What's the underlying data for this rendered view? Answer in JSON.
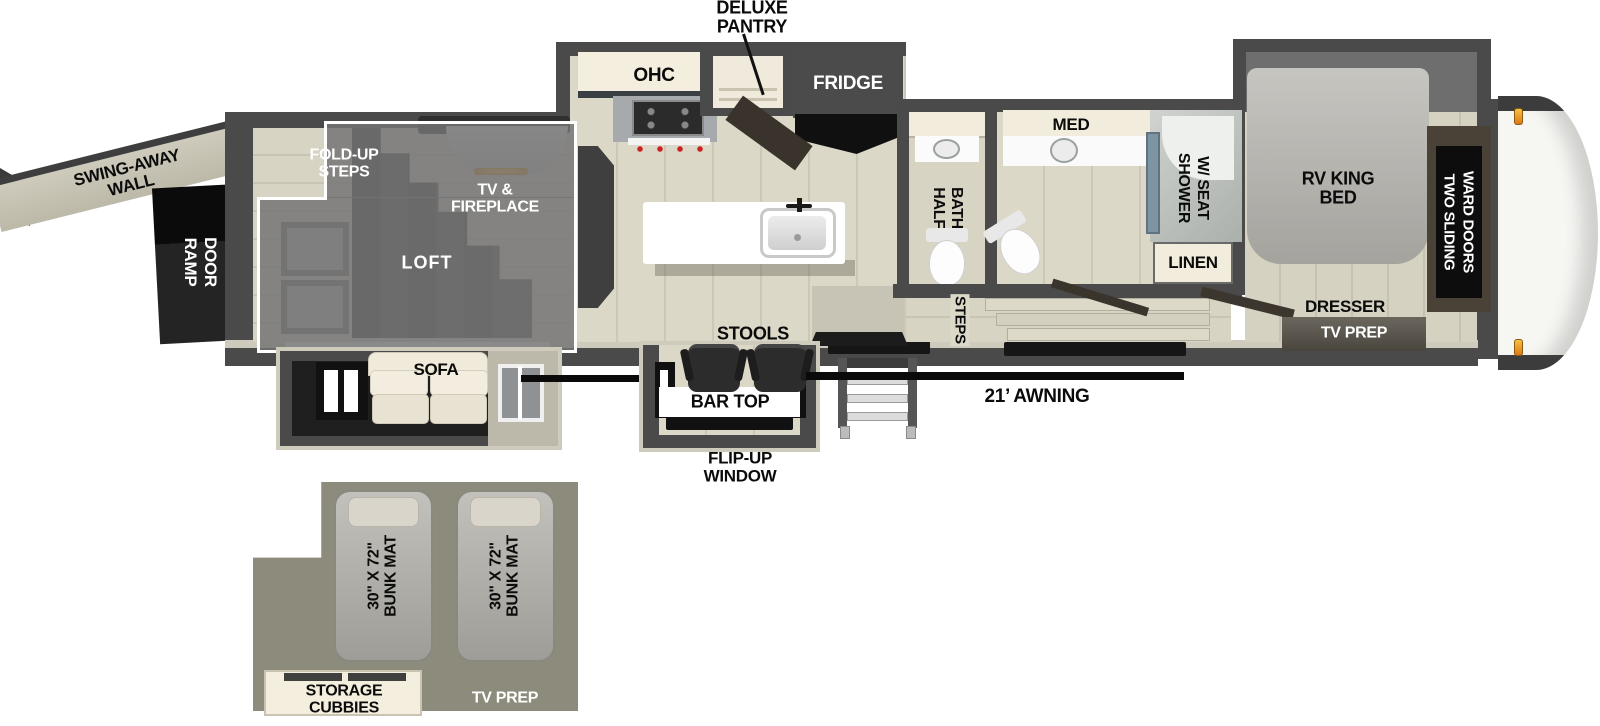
{
  "title": "RV toy hauler floor plan",
  "labels": {
    "deluxe_pantry": "DELUXE\nPANTRY",
    "ohc": "OHC",
    "fridge": "FRIDGE",
    "med": "MED",
    "half_bath": [
      "HALF",
      "BATH"
    ],
    "shower": [
      "SHOWER",
      "W/ SEAT"
    ],
    "linen": "LINEN",
    "steps": "STEPS",
    "rv_king_bed": "RV KING\nBED",
    "ward_doors": [
      "TWO SLIDING",
      "WARD DOORS"
    ],
    "dresser": "DRESSER",
    "tv_prep_bedroom": "TV PREP",
    "swing_away_wall": "SWING-AWAY\nWALL",
    "ramp_door": [
      "RAMP",
      "DOOR"
    ],
    "fold_up_steps": "FOLD-UP\nSTEPS",
    "tv_fireplace": "TV &\nFIREPLACE",
    "loft": "LOFT",
    "sofa": "SOFA",
    "stools": "STOOLS",
    "bar_top": "BAR TOP",
    "flip_up_window": "FLIP-UP\nWINDOW",
    "awning": "21’ AWNING",
    "bunk_mat_1": "30\" X 72\"\nBUNK MAT",
    "bunk_mat_2": "30\" X 72\"\nBUNK MAT",
    "storage_cubbies": "STORAGE\nCUBBIES",
    "tv_prep_bunk": "TV PREP"
  },
  "colors": {
    "wall": "#4a4a4a",
    "trim_beige": "#cfcbbc",
    "floor_light": "#d8d4c4",
    "loft_overlay": "#747474",
    "ramp_black": "#111111",
    "cream_cabinet": "#f3eedd",
    "fridge_gray": "#4b4b4b",
    "bunk_background": "#8d8b7b",
    "mat_gray": "#aeaca4",
    "shower_glass": "#7d95a2",
    "fireplace_glow": "#f0a02c",
    "marker_light": "#e8931e",
    "awning_line": "#0a0a0a"
  }
}
